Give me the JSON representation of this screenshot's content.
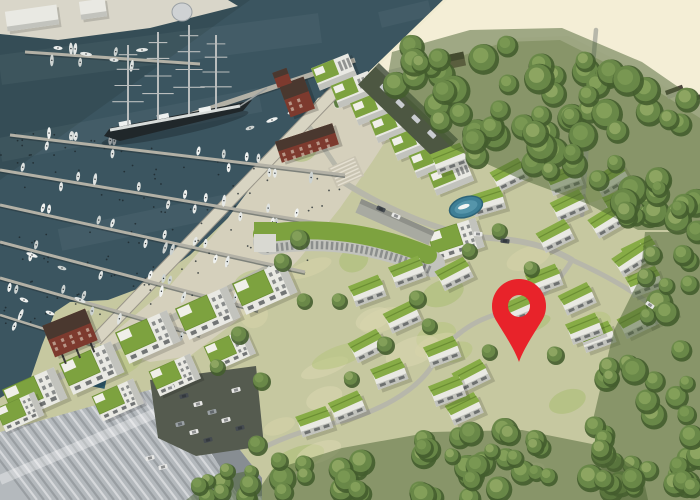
{
  "meta": {
    "alt": "Aerial 3D rendering of a seaside marina resort village with green-roofed buildings, a yacht harbour with a four-masted tall ship, a sandy beach, dense forest and a red location marker",
    "width": 700,
    "height": 500,
    "seed": 11
  },
  "palette": {
    "water": "#3b5560",
    "waterDeep": "#31474f",
    "sand": "#f1ebd1",
    "sandBright": "#f7f2db",
    "land": "#c6c8a0",
    "plaza": "#d5d0bc",
    "quay": "#d9d6c9",
    "promenade": "#d8d4c2",
    "road": "#b7b7aa",
    "roofGreen": "#7da23f",
    "roofGreenBright": "#87ac46",
    "wallWhite": "#e9e9e3",
    "wallShade": "#c2c3bd",
    "windowDark": "#4a4e50",
    "red": "#7d3a2e",
    "redRoof": "#4a382f",
    "treeDark": "#445d2e",
    "treeMid": "#6d8c4a",
    "treeLights": [
      "#8aa55e",
      "#7d9b55",
      "#96ad68"
    ],
    "pier": "#b3b1a6",
    "boatHulls": [
      "#e6e9e7",
      "#dfe3e1",
      "#cdd3d1",
      "#f0f2f0"
    ],
    "hallRoof": "#b4b9bd",
    "hallWall": "#878d92",
    "parking": "#555b4f",
    "pool": "#3e7f96",
    "poolLight": "#5595aa",
    "lapPool": "#2e5a6b",
    "shipHull": "#20272a",
    "shipDeck": "#d8dcda",
    "mast": "#b9bdbd",
    "pin": "#e8232a",
    "carShades": {
      "w": "#e8e8e6",
      "d": "#454b50",
      "g": "#9aa0a4"
    }
  },
  "marker": {
    "x": 519,
    "y": 306,
    "head_r": 27,
    "hole_r": 11,
    "tip_y": 362
  },
  "geography": {
    "water_poly": [
      [
        0,
        0
      ],
      [
        443,
        0
      ],
      [
        352,
        88
      ],
      [
        318,
        98
      ],
      [
        270,
        162
      ],
      [
        228,
        218
      ],
      [
        190,
        255
      ],
      [
        148,
        285
      ],
      [
        108,
        300
      ],
      [
        70,
        302
      ],
      [
        55,
        312
      ],
      [
        42,
        345
      ],
      [
        30,
        380
      ],
      [
        0,
        398
      ]
    ],
    "water_shade_poly": [
      [
        0,
        0
      ],
      [
        250,
        0
      ],
      [
        0,
        180
      ]
    ],
    "sand_poly": [
      [
        443,
        0
      ],
      [
        700,
        0
      ],
      [
        700,
        118
      ],
      [
        640,
        80
      ],
      [
        560,
        40
      ],
      [
        505,
        42
      ],
      [
        455,
        58
      ],
      [
        420,
        72
      ],
      [
        388,
        80
      ],
      [
        352,
        88
      ]
    ],
    "quay_poly": [
      [
        0,
        0
      ],
      [
        228,
        0
      ],
      [
        238,
        6
      ],
      [
        150,
        28
      ],
      [
        58,
        40
      ],
      [
        0,
        34
      ]
    ],
    "plaza_poly": [
      [
        318,
        98
      ],
      [
        352,
        88
      ],
      [
        398,
        122
      ],
      [
        372,
        162
      ],
      [
        340,
        208
      ],
      [
        300,
        258
      ],
      [
        248,
        312
      ],
      [
        190,
        356
      ],
      [
        150,
        362
      ],
      [
        100,
        344
      ],
      [
        168,
        288
      ],
      [
        228,
        218
      ],
      [
        270,
        162
      ]
    ],
    "promenade_path": "M340,86 L96,340",
    "beach_walk_path": "M340,86 L443,60",
    "water_streaks": [
      {
        "d": "M0,70 L320,28",
        "w": 30
      },
      {
        "d": "M0,150 L260,100",
        "w": 24
      },
      {
        "d": "M60,240 L300,190",
        "w": 22
      },
      {
        "d": "M380,20 L430,8",
        "w": 16
      }
    ]
  },
  "marina": {
    "piers": [
      {
        "x1": 25,
        "y1": 52,
        "x2": 200,
        "y2": 64,
        "boats": 6,
        "w": 3
      },
      {
        "x1": 10,
        "y1": 135,
        "x2": 345,
        "y2": 175,
        "boats": 16,
        "w": 3
      },
      {
        "x1": 0,
        "y1": 170,
        "x2": 330,
        "y2": 225,
        "boats": 15,
        "w": 3
      },
      {
        "x1": 0,
        "y1": 205,
        "x2": 305,
        "y2": 272,
        "boats": 13,
        "w": 3
      },
      {
        "x1": 0,
        "y1": 242,
        "x2": 258,
        "y2": 310,
        "boats": 11,
        "w": 3
      },
      {
        "x1": 0,
        "y1": 278,
        "x2": 200,
        "y2": 335,
        "boats": 9,
        "w": 3
      },
      {
        "x1": 0,
        "y1": 315,
        "x2": 95,
        "y2": 345,
        "boats": 5,
        "w": 2.5
      },
      {
        "x1": 130,
        "y1": 135,
        "x2": 355,
        "y2": 60,
        "boats": 0,
        "w": 5
      }
    ],
    "pole_field": [
      [
        0,
        128
      ],
      [
        348,
        168
      ],
      [
        305,
        285
      ],
      [
        0,
        335
      ]
    ],
    "pole_count": 160,
    "free_boats": [
      [
        32,
        255,
        20
      ],
      [
        62,
        268,
        18
      ],
      [
        24,
        300,
        22
      ],
      [
        50,
        313,
        20
      ],
      [
        80,
        300,
        24
      ],
      [
        58,
        48,
        5
      ],
      [
        86,
        54,
        8
      ],
      [
        114,
        60,
        5
      ],
      [
        142,
        50,
        -4
      ],
      [
        250,
        128,
        -18
      ],
      [
        272,
        120,
        -20
      ],
      [
        292,
        112,
        -20
      ]
    ]
  },
  "ship": {
    "hull": [
      [
        104,
        136
      ],
      [
        110,
        128
      ],
      [
        235,
        104
      ],
      [
        252,
        100
      ],
      [
        243,
        111
      ],
      [
        120,
        141
      ]
    ],
    "deck": [
      [
        110,
        130
      ],
      [
        240,
        106
      ]
    ],
    "bowsprit": [
      [
        240,
        106
      ],
      [
        267,
        88
      ]
    ],
    "masts": [
      {
        "x": 128,
        "base": 126,
        "top": 45
      },
      {
        "x": 158,
        "base": 120,
        "top": 32
      },
      {
        "x": 189,
        "base": 114,
        "top": 25
      },
      {
        "x": 216,
        "base": 109,
        "top": 35
      }
    ],
    "houses": [
      [
        125,
        124
      ],
      [
        163,
        117
      ],
      [
        205,
        110
      ]
    ]
  },
  "buildings": {
    "terraces": {
      "start": [
        334,
        72
      ],
      "step": [
        19.5,
        17.5
      ],
      "count": 7,
      "angle": -22
    },
    "garage": {
      "cx": 408,
      "cy": 112,
      "len": 110,
      "w": 30,
      "angle": 44,
      "cars": 4
    },
    "hotel": {
      "facade": "M266,242 Q348,228 432,264",
      "roof": "M262,234 Q346,221 428,255",
      "tower": [
        254,
        222,
        22,
        30
      ]
    },
    "slab": {
      "cx": 395,
      "cy": 222,
      "len": 80,
      "w": 15,
      "angle": 24
    },
    "apartments": [
      {
        "x": 265,
        "y": 288,
        "s": 1,
        "r": -24
      },
      {
        "x": 208,
        "y": 313,
        "s": 1,
        "r": -24
      },
      {
        "x": 148,
        "y": 337,
        "s": 1,
        "r": -24
      },
      {
        "x": 92,
        "y": 368,
        "s": 1,
        "r": -24
      },
      {
        "x": 35,
        "y": 394,
        "s": 1,
        "r": -24
      },
      {
        "x": 230,
        "y": 350,
        "s": 0.8,
        "r": -24
      },
      {
        "x": 175,
        "y": 375,
        "s": 0.8,
        "r": -24
      },
      {
        "x": 118,
        "y": 400,
        "s": 0.8,
        "r": -24
      },
      {
        "x": 456,
        "y": 240,
        "s": 0.9,
        "r": -18
      },
      {
        "x": 20,
        "y": 412,
        "s": 0.75,
        "r": -24
      }
    ],
    "villas": [
      [
        450,
        160,
        -20
      ],
      [
        510,
        176,
        -26
      ],
      [
        565,
        181,
        -20
      ],
      [
        612,
        181,
        -30
      ],
      [
        488,
        203,
        -16
      ],
      [
        570,
        207,
        -24
      ],
      [
        622,
        203,
        -20
      ],
      [
        556,
        237,
        -26
      ],
      [
        608,
        222,
        -30
      ],
      [
        641,
        253,
        -24
      ],
      [
        645,
        283,
        -20
      ],
      [
        658,
        313,
        -26
      ],
      [
        632,
        260,
        -32
      ],
      [
        408,
        273,
        -20
      ],
      [
        455,
        275,
        -26
      ],
      [
        545,
        281,
        -20
      ],
      [
        578,
        300,
        -24
      ],
      [
        598,
        338,
        -20
      ],
      [
        637,
        323,
        -26
      ],
      [
        368,
        292,
        -20
      ],
      [
        403,
        318,
        -24
      ],
      [
        443,
        353,
        -20
      ],
      [
        472,
        377,
        -26
      ],
      [
        390,
        375,
        -20
      ],
      [
        465,
        410,
        -24
      ],
      [
        368,
        347,
        -26
      ],
      [
        585,
        330,
        -20
      ],
      [
        520,
        310,
        -22
      ],
      [
        448,
        392,
        -20
      ],
      [
        315,
        423,
        -18
      ],
      [
        348,
        408,
        -22
      ]
    ],
    "reds": [
      {
        "cx": 297,
        "cy": 97,
        "w": 26,
        "h": 34,
        "angle": -20,
        "tower": true,
        "stilts": false
      },
      {
        "cx": 307,
        "cy": 143,
        "w": 60,
        "h": 22,
        "angle": -18,
        "tower": false,
        "stilts": false
      },
      {
        "cx": 70,
        "cy": 333,
        "w": 46,
        "h": 34,
        "angle": -22,
        "tower": false,
        "stilts": true
      }
    ],
    "hall": {
      "poly": [
        [
          0,
          432
        ],
        [
          185,
          380
        ],
        [
          262,
          478
        ],
        [
          262,
          500
        ],
        [
          0,
          500
        ]
      ],
      "wall": [
        [
          185,
          380
        ],
        [
          262,
          478
        ],
        [
          262,
          496
        ],
        [
          240,
          498
        ],
        [
          172,
          392
        ]
      ],
      "band": [
        [
          0,
          480
        ],
        [
          205,
          392
        ]
      ],
      "rib_gap": 7
    },
    "harbor_sheds": [
      {
        "x": 6,
        "y": 8,
        "w": 52,
        "h": 20,
        "r": -8
      },
      {
        "x": 80,
        "y": 0,
        "w": 26,
        "h": 18,
        "r": -8
      }
    ],
    "silo": {
      "cx": 182,
      "cy": 12,
      "rx": 10,
      "ry": 9
    },
    "right_houses": [
      [
        675,
        92,
        -20
      ],
      [
        695,
        101,
        -20
      ]
    ],
    "beach_hut": {
      "cx": 448,
      "cy": 62,
      "w": 34,
      "h": 14,
      "angle": -12
    },
    "stairs": {
      "cx": 346,
      "cy": 172,
      "angle": -24
    }
  },
  "amenities": {
    "pool": {
      "cx": 466,
      "cy": 207,
      "rx": 17,
      "ry": 10,
      "angle": -18
    },
    "lap_pool": {
      "x": 96,
      "y": 346,
      "w": 13,
      "h": 42,
      "angle": 12
    },
    "fields": [
      [
        352,
        95,
        40,
        16,
        -18
      ],
      [
        376,
        106,
        44,
        18,
        -18
      ],
      [
        400,
        120,
        48,
        18,
        -18
      ]
    ],
    "pond": [
      357,
      103,
      4
    ]
  },
  "roads": [
    {
      "d": "M340,180 C395,215 450,235 490,238 C525,240 552,248 572,260",
      "w": 6
    },
    {
      "d": "M572,260 C556,288 530,306 498,314 C468,322 445,342 432,366",
      "w": 5
    },
    {
      "d": "M432,366 C415,392 378,412 338,422 C300,431 272,442 256,452",
      "w": 5
    },
    {
      "d": "M572,260 C612,278 645,298 666,318",
      "w": 5
    },
    {
      "d": "M596,30 C590,95 586,155 582,215",
      "w": 4.5
    },
    {
      "d": "M268,268 C220,294 168,320 120,345 C80,366 48,382 26,396",
      "w": 7
    },
    {
      "d": "M310,128 C322,146 334,162 342,176",
      "w": 5
    }
  ],
  "cars": {
    "parking_surface": [
      [
        150,
        380
      ],
      [
        256,
        366
      ],
      [
        264,
        446
      ],
      [
        196,
        456
      ],
      [
        158,
        438
      ]
    ],
    "parking": [
      [
        170,
        388,
        -14,
        "w"
      ],
      [
        184,
        396,
        -14,
        "d"
      ],
      [
        198,
        404,
        -14,
        "w"
      ],
      [
        212,
        412,
        -14,
        "g"
      ],
      [
        226,
        420,
        -14,
        "w"
      ],
      [
        240,
        428,
        -14,
        "d"
      ],
      [
        180,
        424,
        -14,
        "g"
      ],
      [
        194,
        432,
        -14,
        "w"
      ],
      [
        208,
        440,
        -14,
        "d"
      ],
      [
        236,
        390,
        -14,
        "w"
      ],
      [
        150,
        458,
        -14,
        "w"
      ],
      [
        163,
        467,
        -14,
        "w"
      ]
    ],
    "road_cars": [
      [
        478,
        234,
        4,
        "w"
      ],
      [
        505,
        241,
        8,
        "d"
      ],
      [
        650,
        305,
        35,
        "w"
      ],
      [
        381,
        209,
        24,
        "d"
      ],
      [
        396,
        216,
        24,
        "w"
      ]
    ]
  },
  "forest": {
    "clusters": [
      {
        "poly": [
          [
            392,
            52
          ],
          [
            470,
            30
          ],
          [
            562,
            28
          ],
          [
            642,
            62
          ],
          [
            700,
            102
          ],
          [
            700,
            230
          ],
          [
            638,
            230
          ],
          [
            588,
            204
          ],
          [
            518,
            178
          ],
          [
            452,
            148
          ],
          [
            408,
            104
          ],
          [
            388,
            76
          ]
        ],
        "count": 72,
        "rmin": 9,
        "rmax": 16
      },
      {
        "poly": [
          [
            645,
            232
          ],
          [
            700,
            232
          ],
          [
            700,
            500
          ],
          [
            608,
            500
          ],
          [
            592,
            424
          ],
          [
            614,
            330
          ],
          [
            640,
            278
          ]
        ],
        "count": 42,
        "rmin": 8,
        "rmax": 14
      },
      {
        "poly": [
          [
            252,
            500
          ],
          [
            272,
            470
          ],
          [
            342,
            448
          ],
          [
            432,
            432
          ],
          [
            522,
            430
          ],
          [
            602,
            446
          ],
          [
            642,
            472
          ],
          [
            648,
            500
          ]
        ],
        "count": 46,
        "rmin": 8,
        "rmax": 14
      },
      {
        "poly": [
          [
            186,
            500
          ],
          [
            214,
            478
          ],
          [
            252,
            470
          ],
          [
            254,
            500
          ]
        ],
        "count": 8,
        "rmin": 7,
        "rmax": 11
      }
    ],
    "singles": [
      [
        300,
        240,
        10
      ],
      [
        283,
        263,
        9
      ],
      [
        340,
        302,
        8
      ],
      [
        418,
        300,
        9
      ],
      [
        430,
        327,
        8
      ],
      [
        386,
        346,
        9
      ],
      [
        352,
        380,
        8
      ],
      [
        262,
        382,
        9
      ],
      [
        490,
        353,
        8
      ],
      [
        556,
        356,
        9
      ],
      [
        532,
        270,
        8
      ],
      [
        500,
        232,
        8
      ],
      [
        470,
        252,
        8
      ],
      [
        305,
        302,
        8
      ],
      [
        240,
        336,
        9
      ],
      [
        218,
        368,
        8
      ],
      [
        258,
        446,
        10
      ],
      [
        280,
        462,
        9
      ],
      [
        306,
        477,
        9
      ],
      [
        228,
        472,
        8
      ],
      [
        200,
        487,
        9
      ],
      [
        680,
        210,
        9
      ],
      [
        660,
        190,
        8
      ]
    ]
  },
  "texture": {
    "grass_patch_count": 26,
    "grass_region": [
      60,
      140,
      690,
      480
    ],
    "patch_colors": [
      "#d8d4aa",
      "#b4c47a",
      "#a6bb6b",
      "#dcd7b2"
    ]
  }
}
